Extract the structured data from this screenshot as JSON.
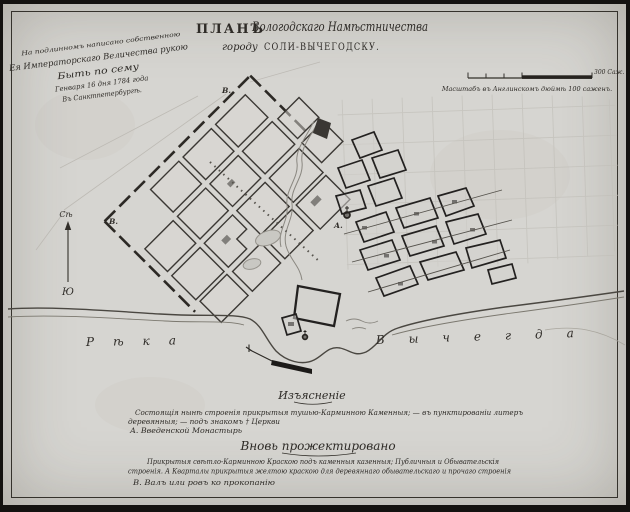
{
  "title": {
    "word_plan": "ПЛАНЪ",
    "region": "Вологодскаго Намѣстничества",
    "line2_prefix": "городу",
    "line2_city": "СОЛИ-ВЫЧЕГОДСКУ."
  },
  "imperial_note": {
    "line1": "На подлинномъ написано собственною",
    "line2": "Ея Императорскаго Величества рукою",
    "line3": "Быть по сему",
    "line4": "Генваря 16 дня 1784 года",
    "line5": "Въ Санктпетербургѣ."
  },
  "scale_bar": {
    "end_label": "300 Саж.",
    "caption": "Масштабъ въ Англинскомъ дюймѣ 100 саженъ."
  },
  "compass": {
    "north": "Сѣ",
    "south": "Ю"
  },
  "map_markers": {
    "rampart_top": "В.",
    "rampart_left": "В.",
    "monastery": "А."
  },
  "river": {
    "word1": "Рѣка",
    "word2": "Вычегда"
  },
  "legend": {
    "heading_existing": "Изъясненіе",
    "existing_line1": "Состоящія нынѣ строенія прикрытыя тушью-Карминною Каменныя; — въ пунктированіи литеръ",
    "existing_line2": "деревянныя; — подъ знакомъ † Церкви",
    "item_a": "А. Введенской Монастырь",
    "heading_projected": "Вновь прожектировано",
    "projected_line1": "Прикрытыя свѣтло-Карминною Краскою подъ каменныя казенныя; Публичныя и Обывательскія",
    "projected_line2": "строенія. А Кварталы прикрытыя желтою краскою для деревяннаго обывательскаго и прочаго строенія",
    "item_b": "В. Валъ или ровъ ко прокопанію"
  },
  "colors": {
    "paper": "#d6d5d1",
    "ink": "#2e2b27",
    "faint_pencil": "#c2c0ba"
  }
}
